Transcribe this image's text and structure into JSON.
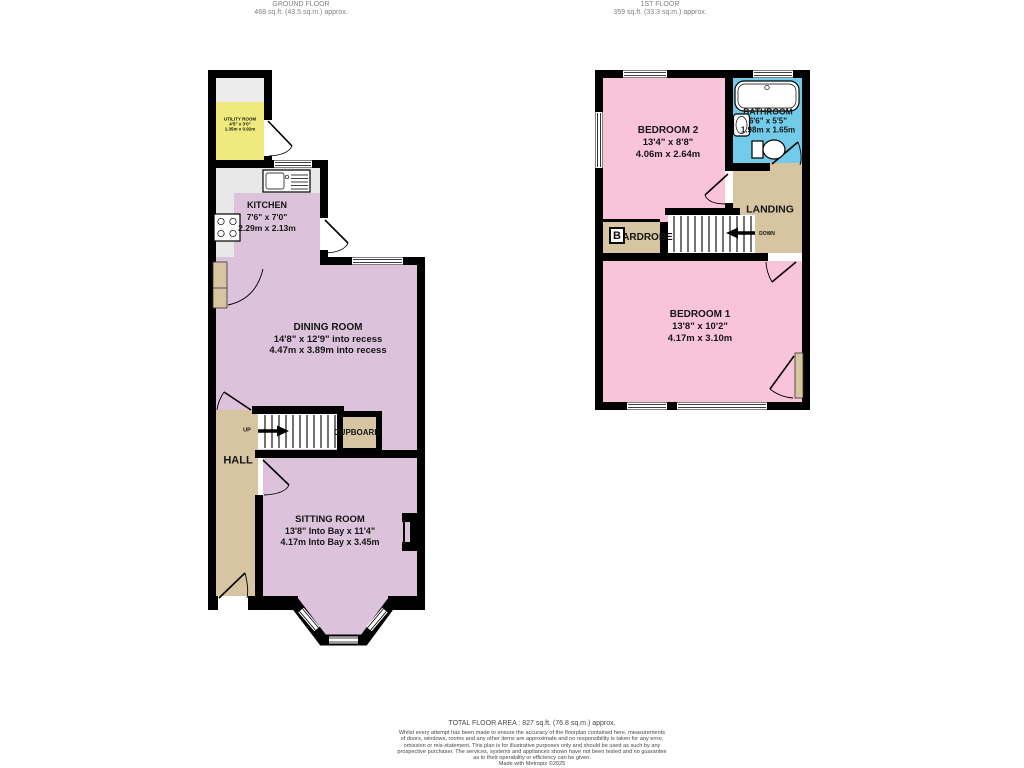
{
  "colors": {
    "wall": "#000000",
    "ground_room": "#dcc3db",
    "bedroom_pink": "#f9c4d9",
    "bathroom_blue": "#72cbe9",
    "utility_yellow": "#efe97e",
    "hallway_tan": "#d7c5a2",
    "kitchen_grey": "#e8e8e8",
    "counter_grey": "#ececec"
  },
  "ground_floor": {
    "header": {
      "title": "GROUND FLOOR",
      "area": "468 sq.ft. (43.5 sq.m.) approx."
    },
    "rooms": {
      "utility": {
        "name": "UTILITY ROOM",
        "imperial": "4'5\" x 3'0\"",
        "metric": "1.35m x 0.92m"
      },
      "kitchen": {
        "name": "KITCHEN",
        "imperial": "7'6\" x 7'0\"",
        "metric": "2.29m x 2.13m"
      },
      "dining": {
        "name": "DINING ROOM",
        "imperial": "14'8\" x 12'9\" into recess",
        "metric": "4.47m x 3.89m into recess"
      },
      "sitting": {
        "name": "SITTING ROOM",
        "imperial": "13'8\" Into Bay x 11'4\"",
        "metric": "4.17m Into Bay x 3.45m"
      },
      "hall": {
        "name": "HALL"
      },
      "cupboard": {
        "name": "CUPBOARD"
      },
      "up_label": "UP"
    }
  },
  "first_floor": {
    "header": {
      "title": "1ST FLOOR",
      "area": "359 sq.ft. (33.3 sq.m.) approx."
    },
    "rooms": {
      "bedroom2": {
        "name": "BEDROOM 2",
        "imperial": "13'4\" x 8'8\"",
        "metric": "4.06m x 2.64m"
      },
      "bathroom": {
        "name": "BATHROOM",
        "imperial": "6'6\" x 5'5\"",
        "metric": "1.98m x 1.65m"
      },
      "bedroom1": {
        "name": "BEDROOM 1",
        "imperial": "13'8\" x 10'2\"",
        "metric": "4.17m x 3.10m"
      },
      "landing": {
        "name": "LANDING"
      },
      "wardrobe": {
        "name": "WARDROBE"
      },
      "down_label": "DOWN",
      "boiler_label": "B"
    }
  },
  "footer": {
    "total": "TOTAL FLOOR AREA : 827 sq.ft. (76.8 sq.m.) approx.",
    "disclaimer_lines": [
      "Whilst every attempt has been made to ensure the accuracy of the floorplan contained here, measurements",
      "of doors, windows, rooms and any other items are approximate and no responsibility is taken for any error,",
      "omission or mis-statement. This plan is for illustrative purposes only and should be used as such by any",
      "prospective purchaser. The services, systems and appliances shown have not been tested and no guarantee",
      "as to their operability or efficiency can be given."
    ],
    "credit": "Made with Metropix ©2025"
  }
}
